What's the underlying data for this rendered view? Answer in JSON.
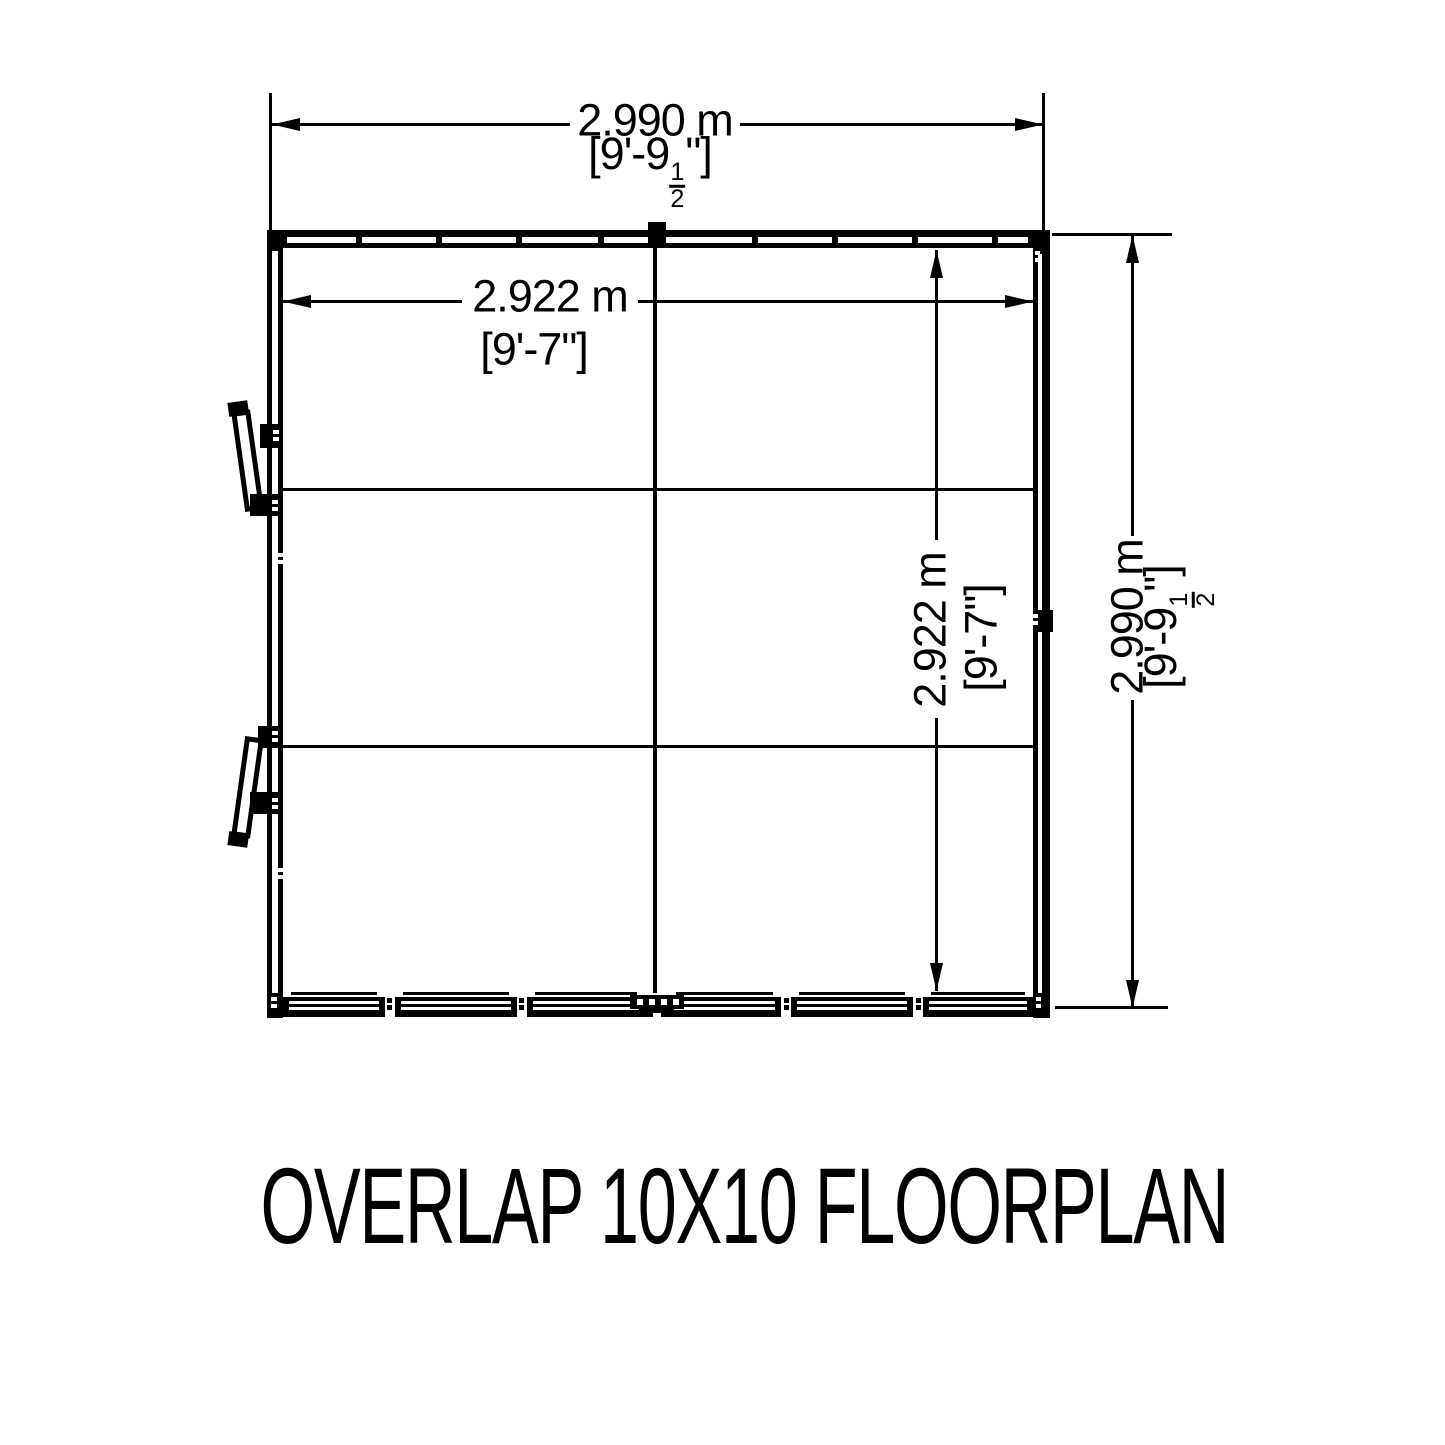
{
  "colors": {
    "ink": "#000000",
    "paper": "#ffffff"
  },
  "title": "OVERLAP 10X10 FLOORPLAN",
  "dimensions": {
    "top_exterior": {
      "metric": "2.990 m",
      "imperial_prefix": "[9'-9",
      "fraction_numerator": "1",
      "fraction_denominator": "2",
      "imperial_suffix": "\"]"
    },
    "top_interior": {
      "metric": "2.922 m",
      "imperial": "[9'-7\"]"
    },
    "right_interior": {
      "metric": "2.922 m",
      "imperial": "[9'-7\"]"
    },
    "right_exterior": {
      "metric": "2.990 m",
      "imperial_prefix": "[9'-9",
      "fraction_numerator": "1",
      "fraction_denominator": "2",
      "imperial_suffix": "\"]"
    }
  }
}
